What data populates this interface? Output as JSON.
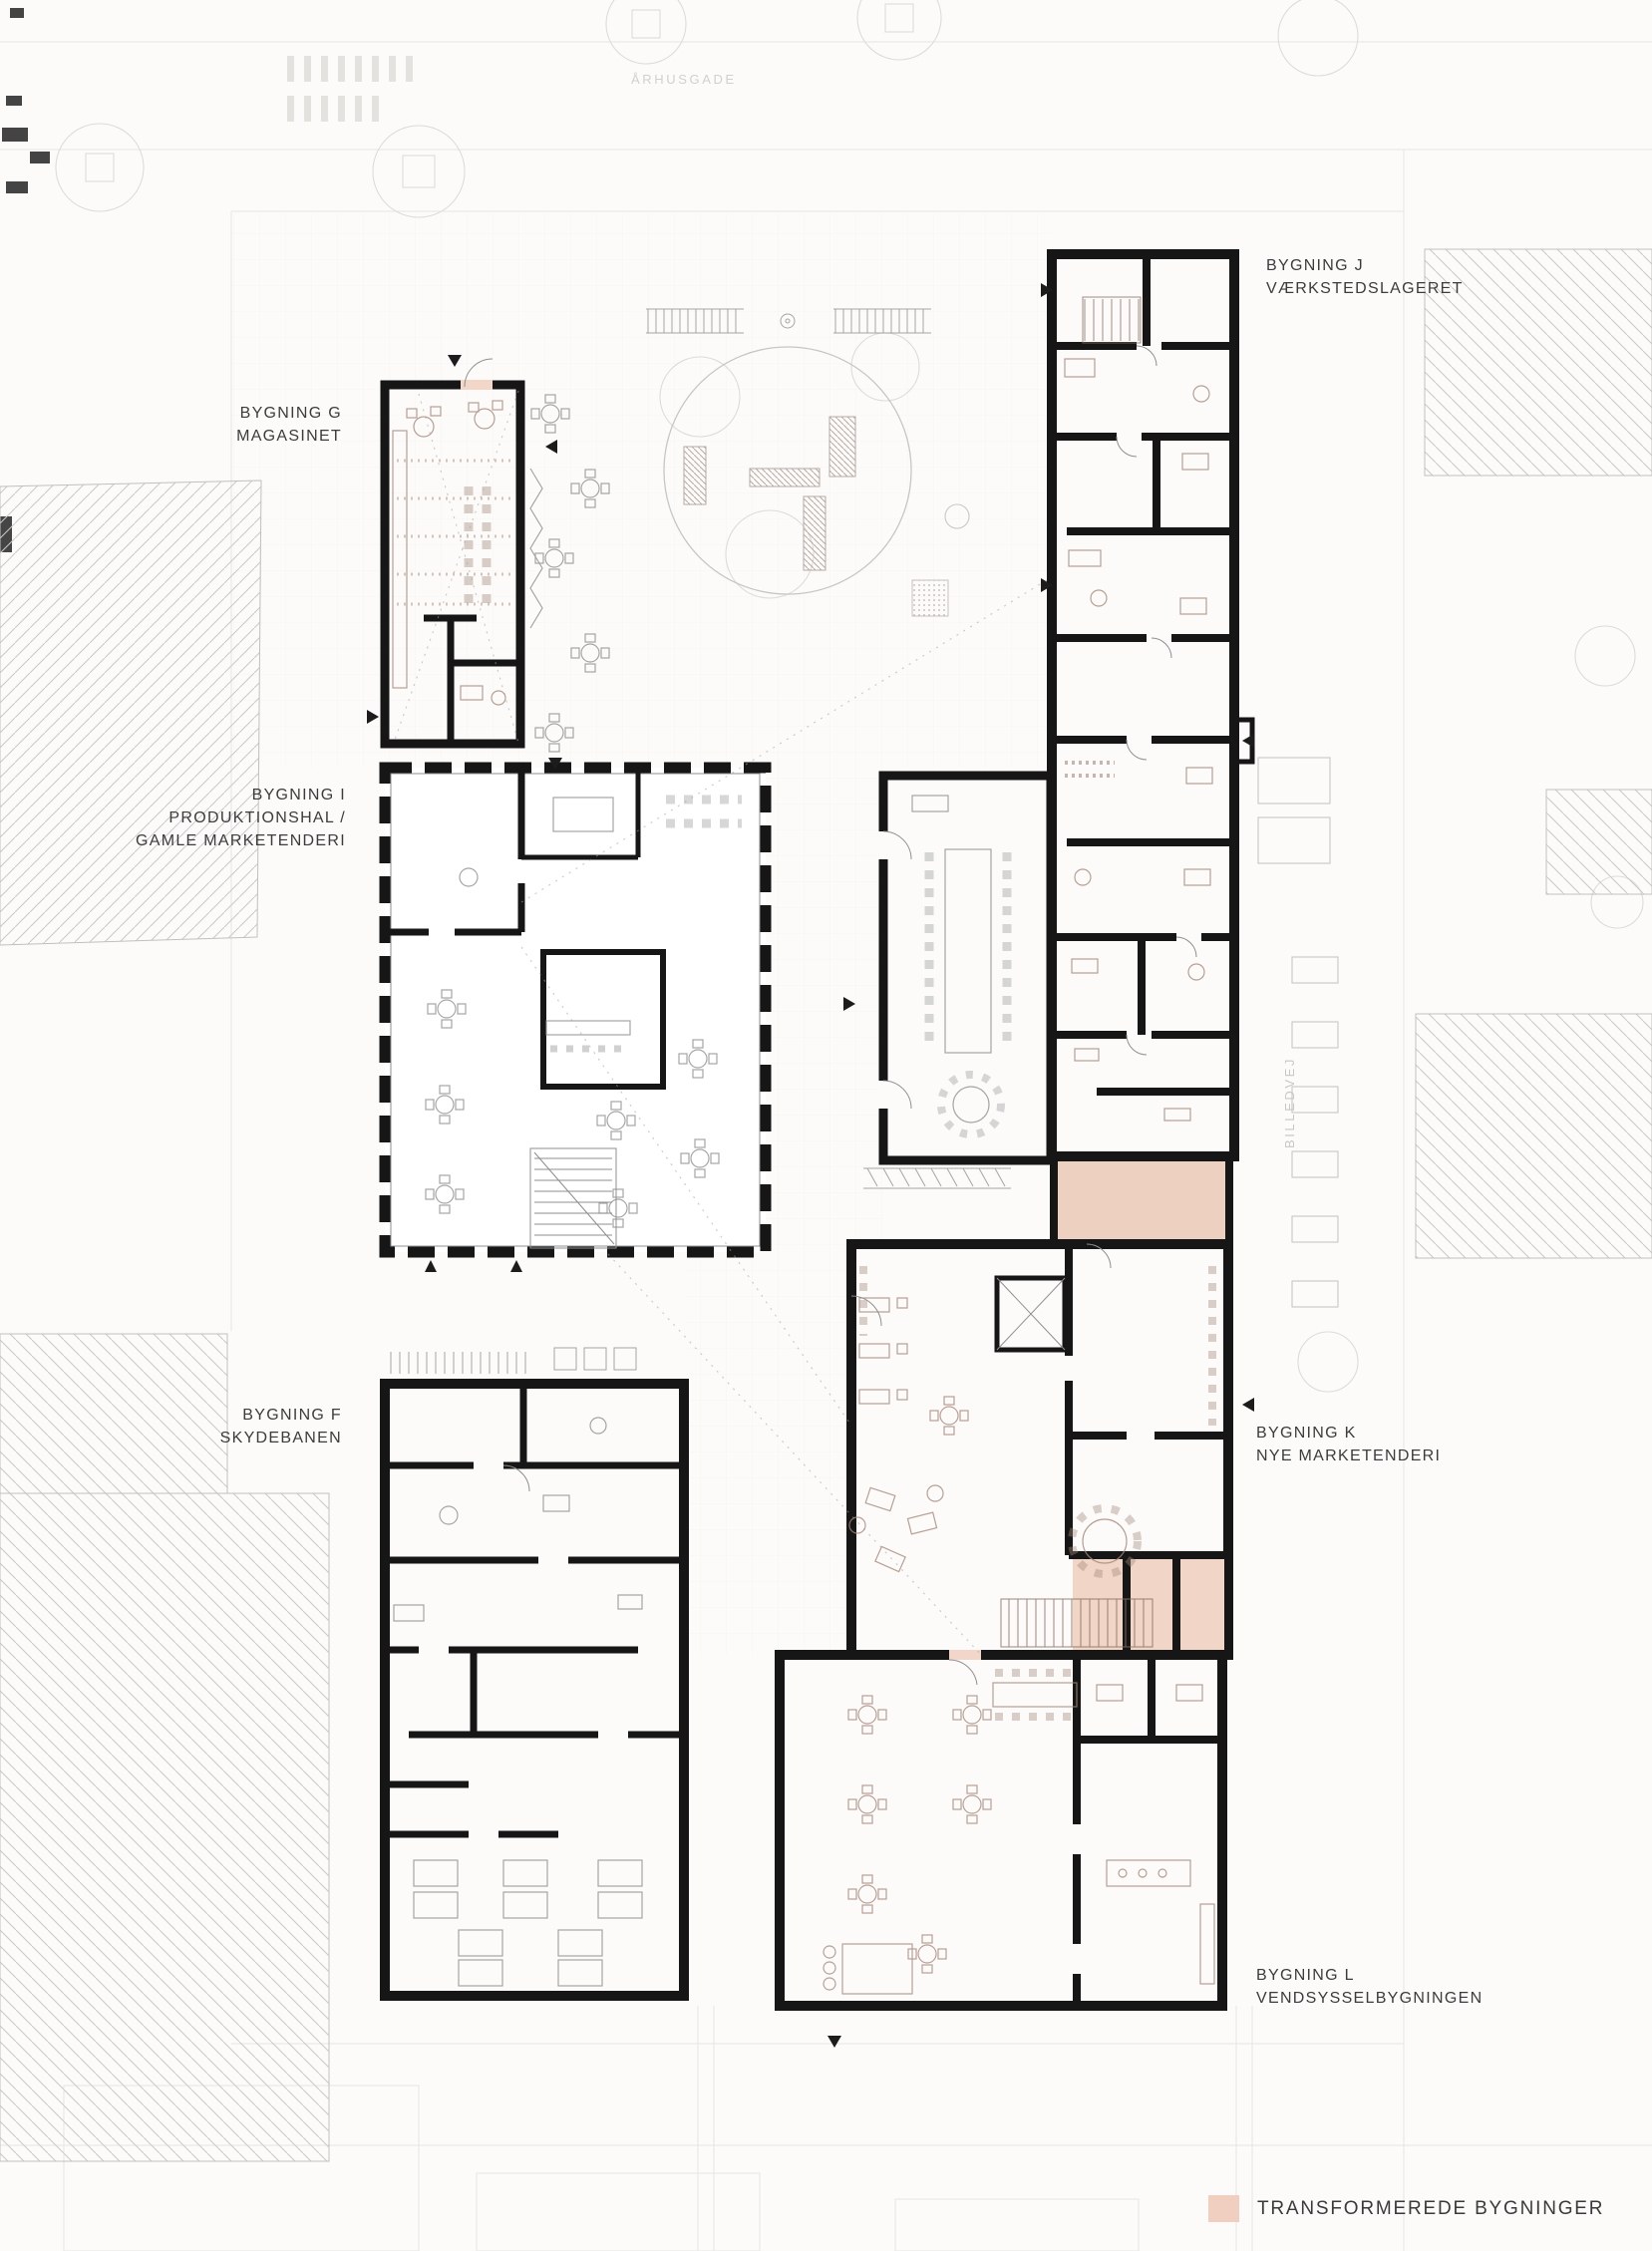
{
  "plan": {
    "streets": {
      "top": "ÅRHUSGADE",
      "right": "BILLEDVEJ"
    },
    "buildings": {
      "g": {
        "lines": [
          "BYGNING G",
          "MAGASINET"
        ],
        "transformed": true
      },
      "j": {
        "lines": [
          "BYGNING J",
          "VÆRKSTEDSLAGERET"
        ],
        "transformed": true
      },
      "i": {
        "lines": [
          "BYGNING I",
          "PRODUKTIONSHAL /",
          "GAMLE MARKETENDERI"
        ],
        "transformed": false
      },
      "f": {
        "lines": [
          "BYGNING F",
          "SKYDEBANEN"
        ],
        "transformed": false
      },
      "k": {
        "lines": [
          "BYGNING K",
          "NYE MARKETENDERI"
        ],
        "transformed": true
      },
      "l": {
        "lines": [
          "BYGNING L",
          "VENDSYSSELBYGNINGEN"
        ],
        "transformed": true
      }
    },
    "legend": {
      "label": "TRANSFORMEREDE BYGNINGER",
      "swatch_color": "#f1cfc0"
    },
    "colors": {
      "transformed_fill": "#f2d7c9",
      "transformed_light_fill": "#f8ebe5",
      "connector_fill": "#eed0c0",
      "wall": "#161616",
      "hatch_line": "#c9c9c9",
      "background": "#fcfbfa"
    }
  }
}
